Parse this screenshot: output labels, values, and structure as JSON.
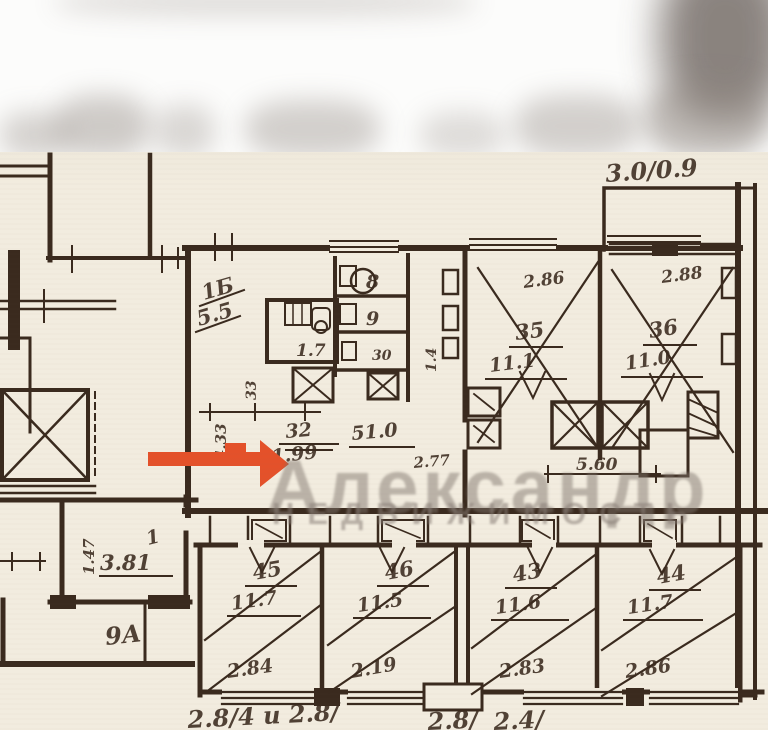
{
  "colors": {
    "paper": "#f2ecdf",
    "ink": "#3a2a1e",
    "arrow": "#e4512a"
  },
  "watermark": {
    "line1": "Александр",
    "line2": "НЕДВИЖИМОСТЬ"
  },
  "annotations": {
    "top_right_note": "3.0/0.9",
    "mid_32": "32",
    "mid_510": "51.0",
    "mid_199": "1.99",
    "mid_277": "2.77",
    "mid_560": "5.60",
    "left_9a": "9А",
    "bottom_left_note": "2.8/4 и 2.8/",
    "bottom_mid_note": "2.8/",
    "bottom_right_note": "2.4/"
  },
  "dimensions": {
    "v_433": "4.33",
    "v_33": "33",
    "v_14": "1.4",
    "v_147": "1.47"
  },
  "kitchen": {
    "number": "1Б",
    "area": "5.5",
    "bath_area": "1.7"
  },
  "cells": {
    "c8": "8",
    "c9": "9",
    "c30": "30"
  },
  "rooms": [
    {
      "number": "35",
      "area": "11.1",
      "width": "2.86"
    },
    {
      "number": "36",
      "area": "11.0",
      "width": "2.88"
    },
    {
      "number": "45",
      "area": "11.7",
      "width": "2.84"
    },
    {
      "number": "46",
      "area": "11.5",
      "width": "2.19"
    },
    {
      "number": "43",
      "area": "11.6",
      "width": "2.83"
    },
    {
      "number": "44",
      "area": "11.7",
      "width": "2.86"
    },
    {
      "number": "1",
      "area": "3.81"
    }
  ]
}
